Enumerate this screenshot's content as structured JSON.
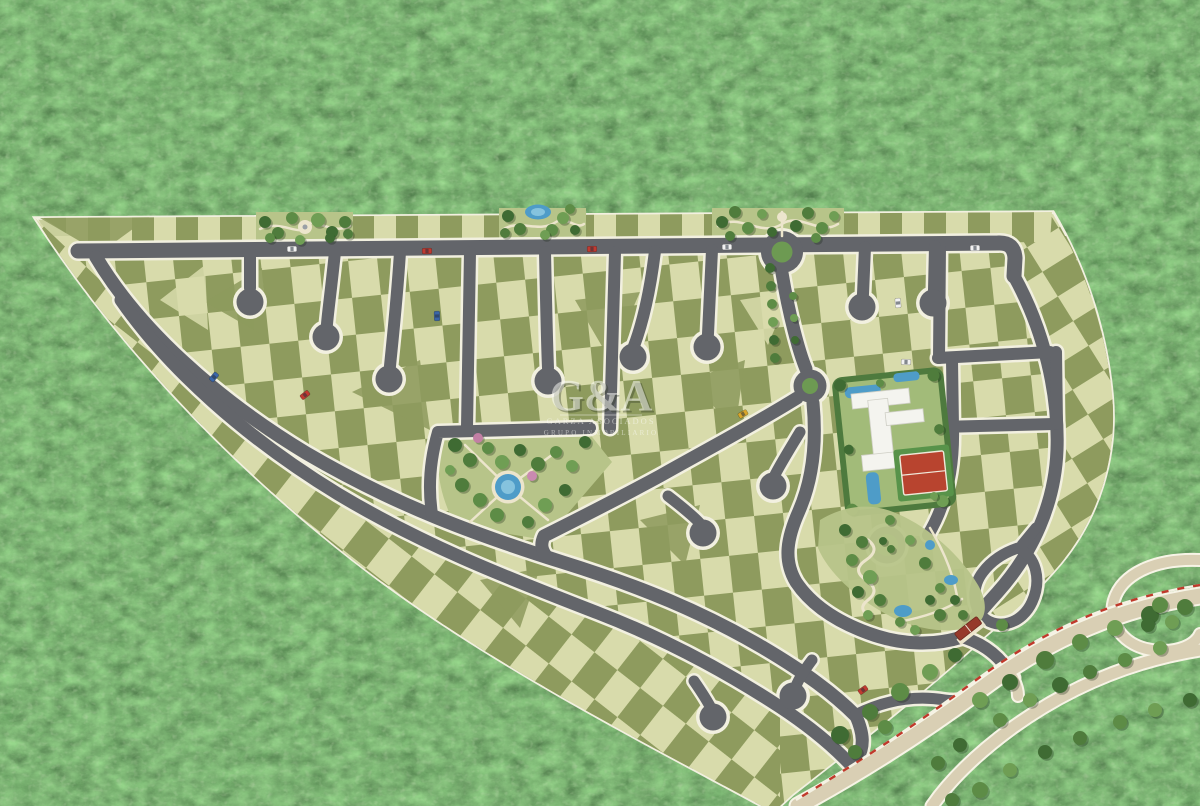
{
  "watermark": {
    "logo": "G&A",
    "line1": "GARZA ASOCIADOS",
    "line2": "GRUPO INMOBILIARIO"
  },
  "colors": {
    "forest_base": "#2c4527",
    "parcel_base": "#c9cf9c",
    "lot_light": "#d8dbab",
    "lot_dark": "#8e9b5e",
    "road": "#63656a",
    "road_edge": "#f2f0e0",
    "external_road": "#d9cfb4",
    "path_beige": "#ece5cc",
    "water": "#4e9cc8",
    "water_light": "#85c3de",
    "island_green": "#6d9a52",
    "park_base": "#b7c489",
    "hedge_green": "#4e7a3e",
    "lawn_green": "#a2bb79",
    "building_white": "#f4f4ef",
    "court_red": "#b8442f",
    "court_apron": "#58934a",
    "gate_roof": "#96392b",
    "utility_red": "#c0392b",
    "car_white": "#f2f2f2",
    "car_red": "#c03a30",
    "car_blue": "#3a66a8",
    "car_yellow": "#d8a62a"
  }
}
